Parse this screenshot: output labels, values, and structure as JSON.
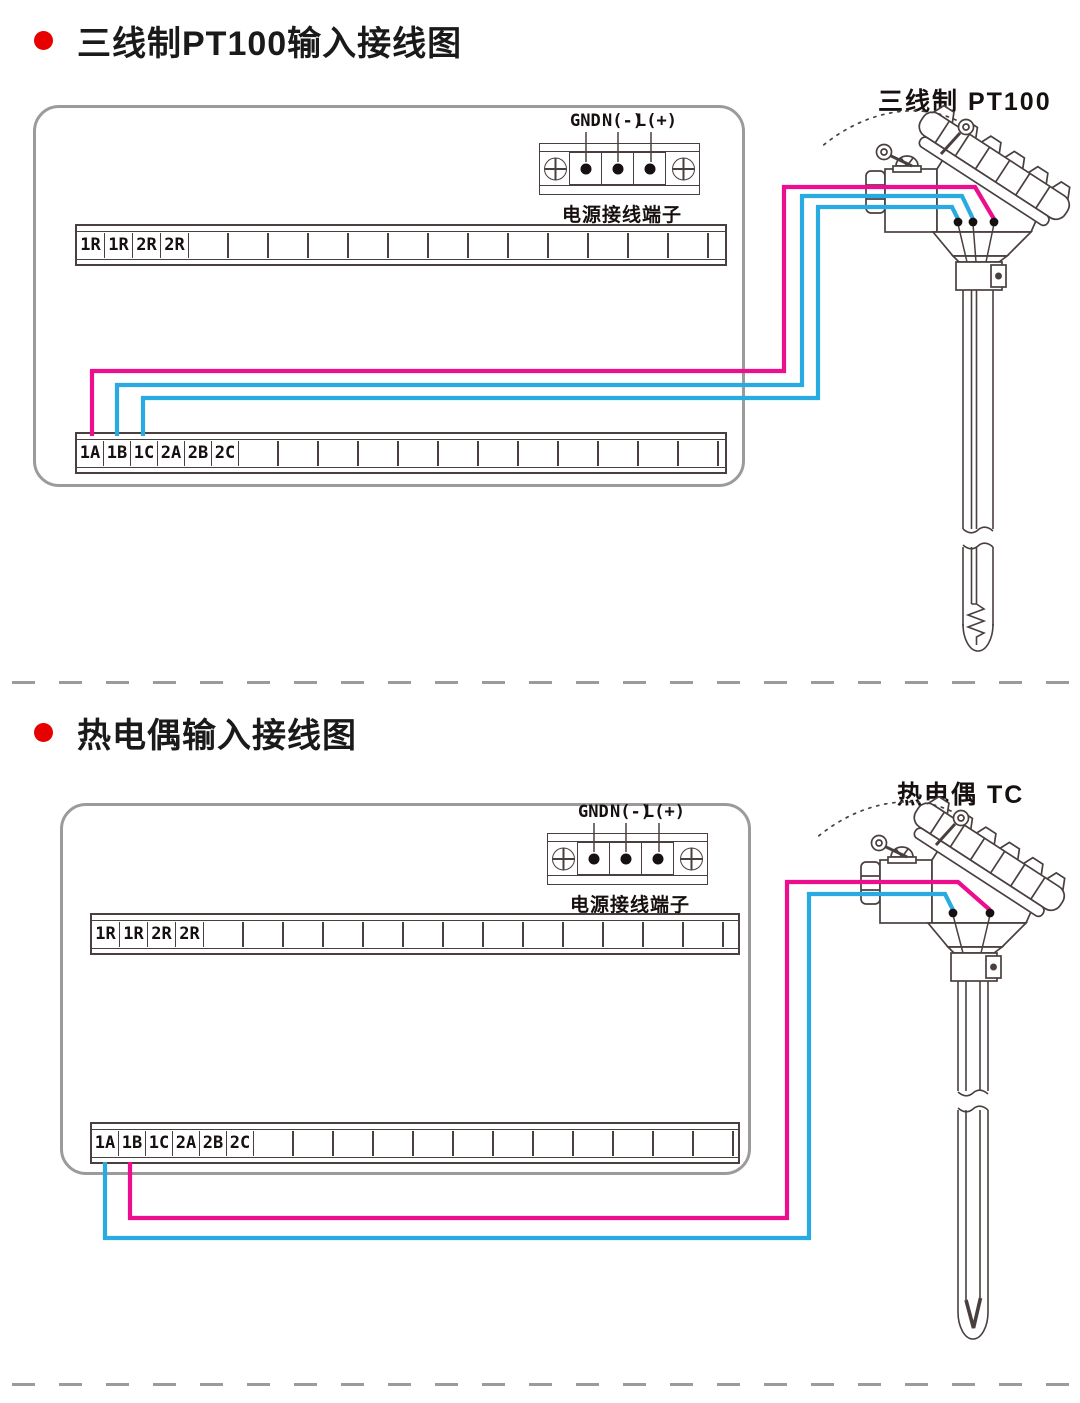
{
  "colors": {
    "wire_pink": "#ec0e8d",
    "wire_blue": "#29abe2",
    "line_art": "#4a3f3f",
    "box_border": "#9b9b9b",
    "bullet_red": "#e60000"
  },
  "section1": {
    "title": "三线制PT100输入接线图",
    "sensor_label": "三线制 PT100",
    "power": {
      "gnd": "GND",
      "n": "N(-)",
      "l": "L(+)",
      "caption": "电源接线端子"
    },
    "relay_cells": [
      "1R",
      "1R",
      "2R",
      "2R"
    ],
    "input_cells": [
      "1A",
      "1B",
      "1C",
      "2A",
      "2B",
      "2C"
    ]
  },
  "section2": {
    "title": "热电偶输入接线图",
    "sensor_label": "热电偶 TC",
    "power": {
      "gnd": "GND",
      "n": "N(-)",
      "l": "L(+)",
      "caption": "电源接线端子"
    },
    "relay_cells": [
      "1R",
      "1R",
      "2R",
      "2R"
    ],
    "input_cells": [
      "1A",
      "1B",
      "1C",
      "2A",
      "2B",
      "2C"
    ]
  }
}
